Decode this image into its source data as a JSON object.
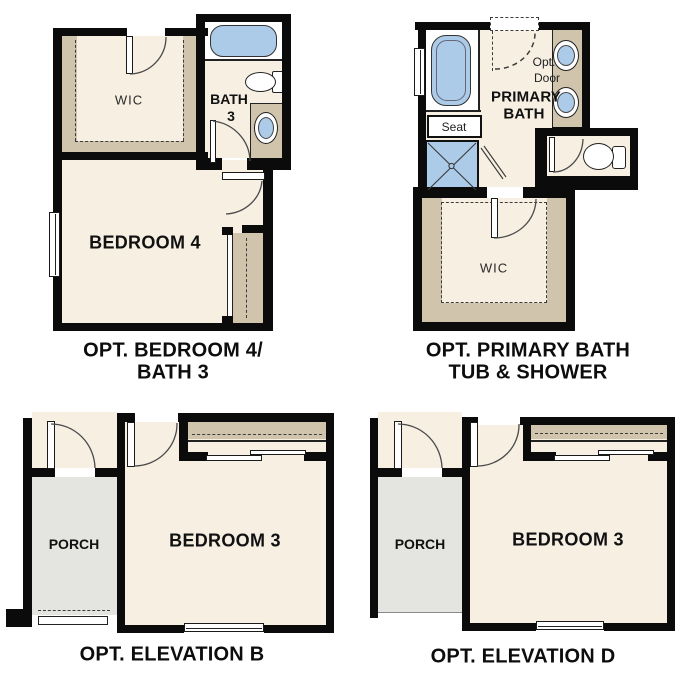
{
  "colors": {
    "wall": "#0b0b0b",
    "floor_beige": "#f6efe2",
    "cabinet_tan": "#d1c4ac",
    "fixture_blue": "#abcbe9",
    "porch_gray": "#e4e4e1",
    "background": "#ffffff"
  },
  "plan_bedroom4": {
    "caption_line1": "OPT. BEDROOM 4/",
    "caption_line2": "BATH 3",
    "wic_label": "WIC",
    "bath_label_line1": "BATH",
    "bath_label_line2": "3",
    "bedroom_label": "BEDROOM 4"
  },
  "plan_primary_bath": {
    "caption_line1": "OPT. PRIMARY BATH",
    "caption_line2": "TUB & SHOWER",
    "room_label_line1": "PRIMARY",
    "room_label_line2": "BATH",
    "seat_label": "Seat",
    "opt_door_line1": "Opt.",
    "opt_door_line2": "Door",
    "wic_label": "WIC"
  },
  "plan_elevation_b": {
    "caption": "OPT. ELEVATION B",
    "porch_label": "PORCH",
    "bedroom_label": "BEDROOM 3"
  },
  "plan_elevation_d": {
    "caption": "OPT. ELEVATION D",
    "porch_label": "PORCH",
    "bedroom_label": "BEDROOM 3"
  }
}
